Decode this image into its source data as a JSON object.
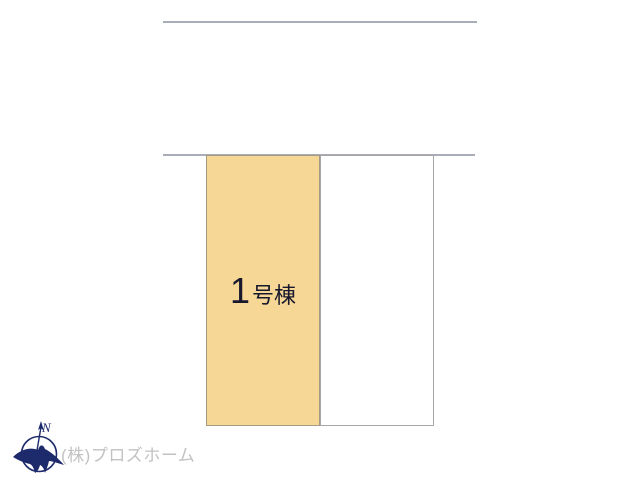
{
  "site_plan": {
    "lots": [
      {
        "id": "lot-1",
        "label_number": "1",
        "label_suffix": "号棟",
        "fill": "#f6d795"
      },
      {
        "id": "lot-2",
        "label": "",
        "fill": "#ffffff"
      }
    ],
    "boundary_lines": 2,
    "line_color": "#a9adb8"
  },
  "compass": {
    "north_label": "N",
    "color": "#1d2a6b"
  },
  "watermark": {
    "company": "(株)プロズホーム",
    "color": "#c2c2c2"
  },
  "colors": {
    "lot_fill": "#f6d795",
    "lot_border": "#a39a85",
    "label_text": "#17172d",
    "background": "#ffffff"
  }
}
